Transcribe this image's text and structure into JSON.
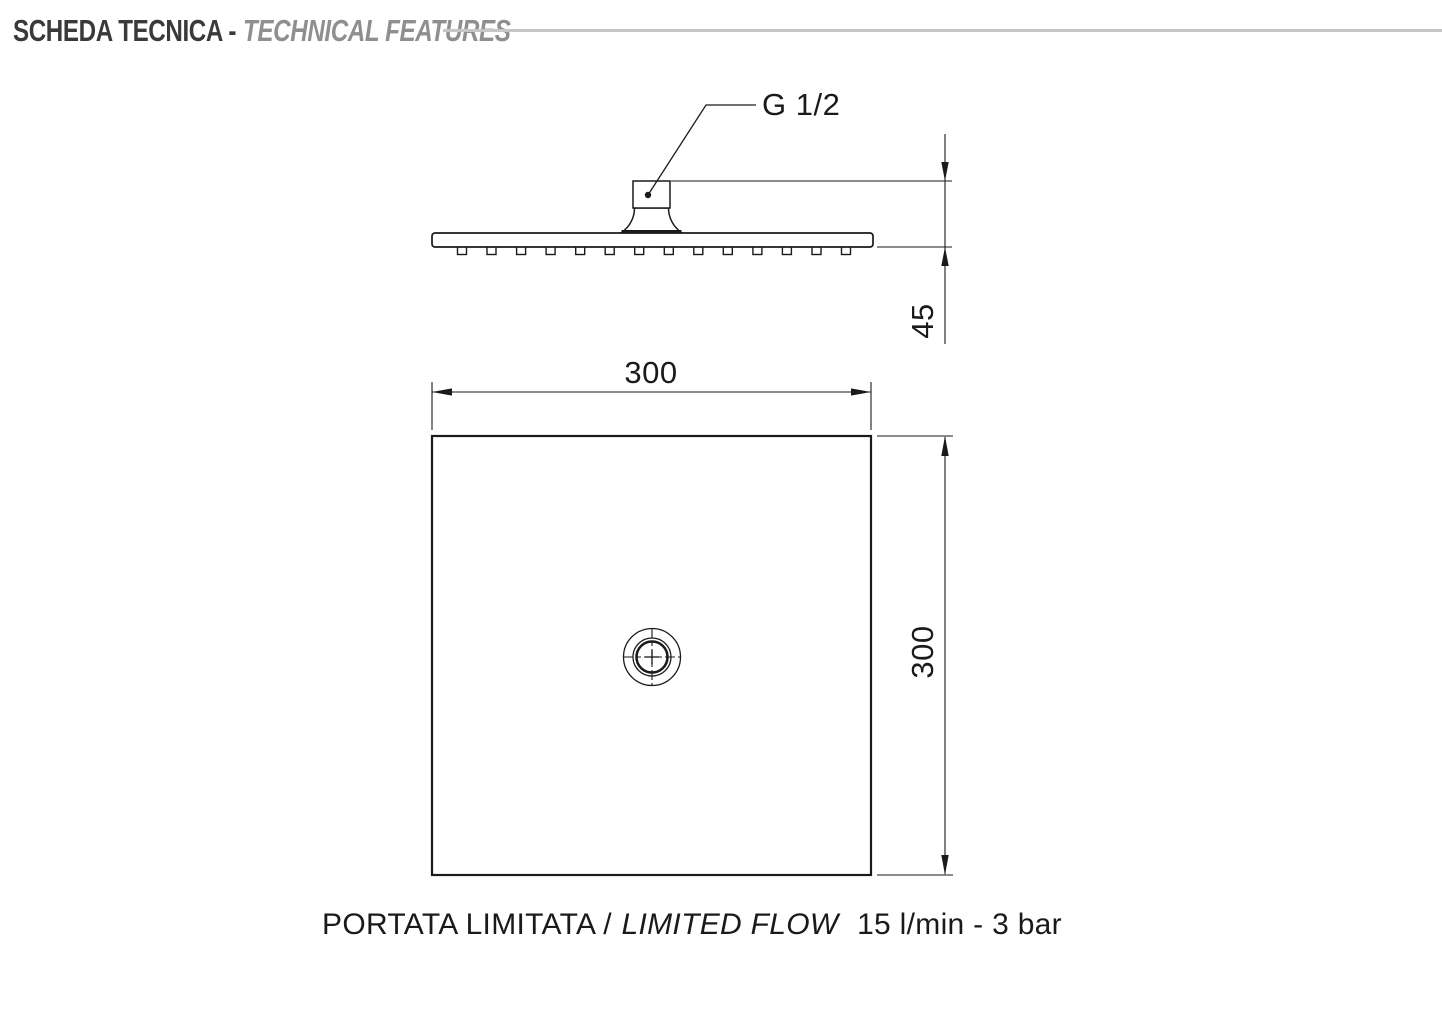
{
  "header": {
    "title_primary": "SCHEDA TECNICA -",
    "title_secondary": "TECHNICAL FEATURES"
  },
  "side_view": {
    "connection_label": "G 1/2",
    "height_dim": "45",
    "nozzle_count": 14
  },
  "top_view": {
    "width_dim": "300",
    "depth_dim": "300"
  },
  "caption": {
    "flow_it": "PORTATA LIMITATA /",
    "flow_en": "LIMITED FLOW",
    "flow_value": "15 l/min - 3 bar"
  },
  "colors": {
    "drawing_line": "#1a1a1a",
    "title_primary": "#3a3a3a",
    "title_secondary": "#8f8f8f",
    "header_rule": "#c6c6c6",
    "background": "#ffffff"
  }
}
